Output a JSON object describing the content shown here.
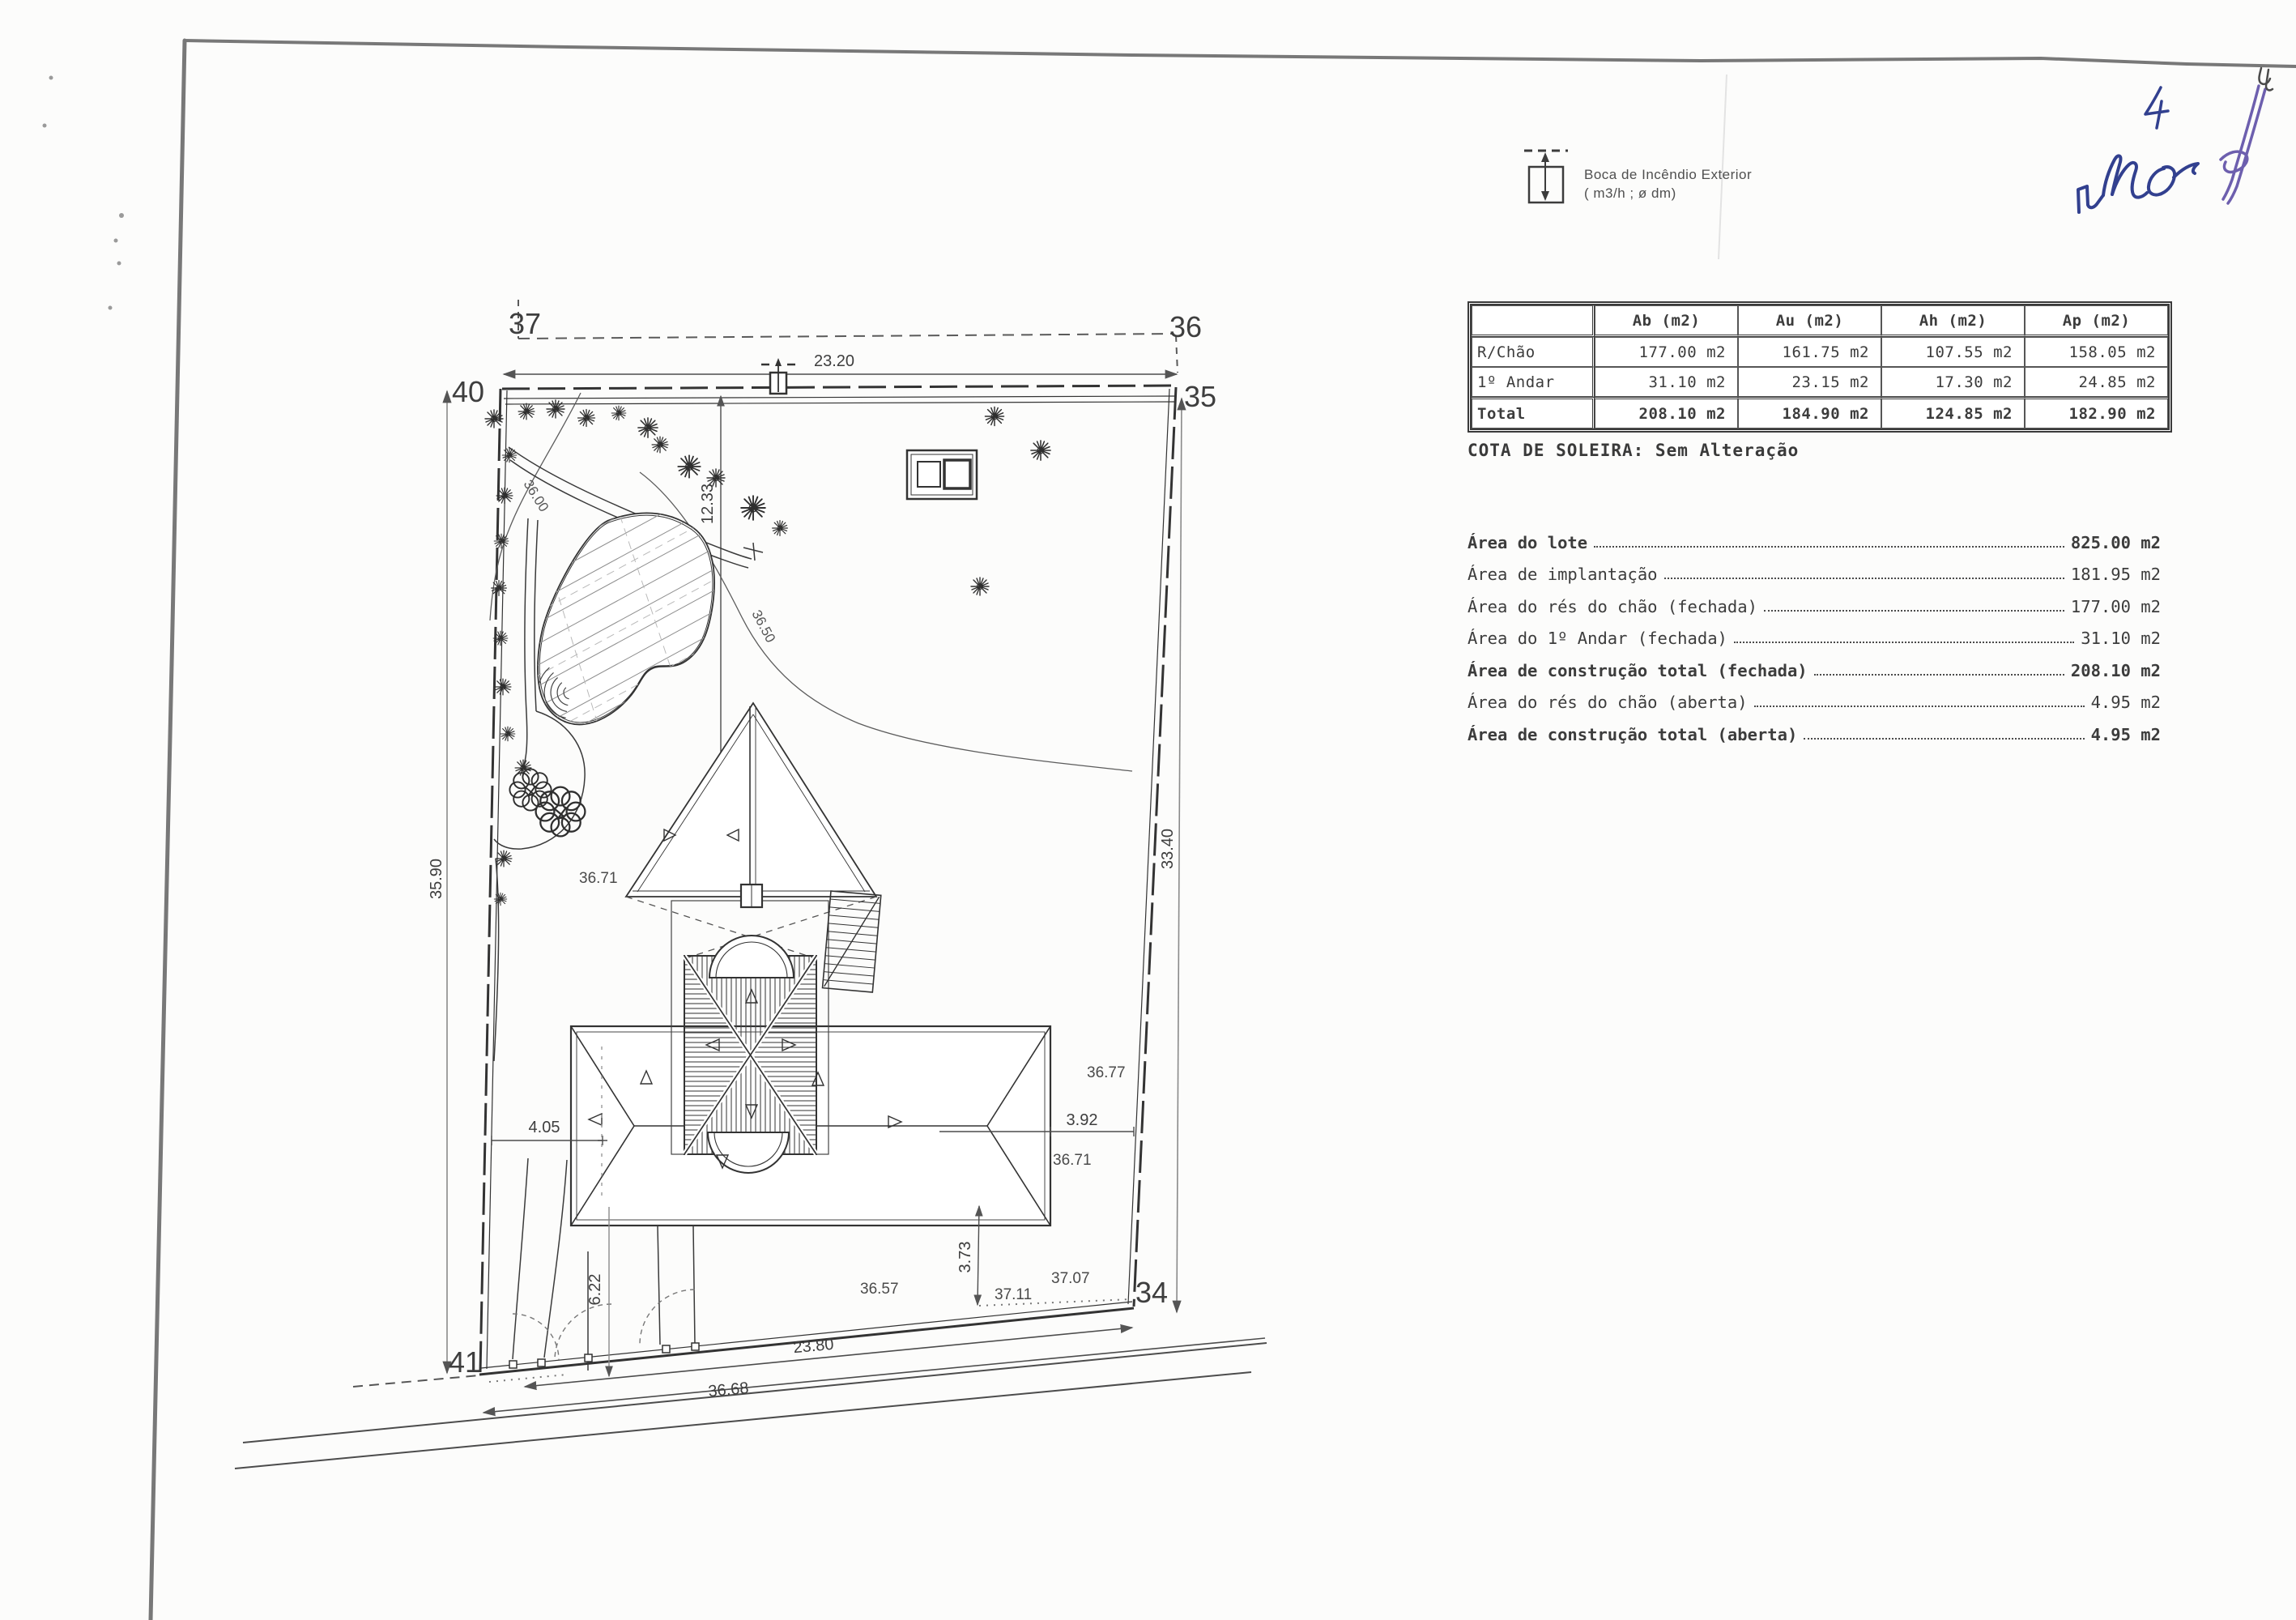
{
  "page": {
    "background": "#fcfcfb",
    "paper_edge_color": "#777777"
  },
  "legend": {
    "icon": "fire-hydrant-icon",
    "line1": "Boca de Incêndio Exterior",
    "line2": "( m3/h ;  ø dm)"
  },
  "areas_table": {
    "col_headers": [
      "",
      "Ab (m2)",
      "Au (m2)",
      "Ah (m2)",
      "Ap (m2)"
    ],
    "rows": [
      {
        "label": "R/Chão",
        "values": [
          "177.00 m2",
          "161.75 m2",
          "107.55 m2",
          "158.05 m2"
        ]
      },
      {
        "label": "1º Andar",
        "values": [
          "31.10 m2",
          "23.15 m2",
          "17.30 m2",
          "24.85 m2"
        ]
      },
      {
        "label": "Total",
        "values": [
          "208.10 m2",
          "184.90 m2",
          "124.85 m2",
          "182.90 m2"
        ]
      }
    ]
  },
  "cota_soleira": "COTA DE SOLEIRA: Sem Alteração",
  "area_list": [
    {
      "label": "Área do lote",
      "value": "825.00 m2",
      "bold": true
    },
    {
      "label": "Área de implantação",
      "value": "181.95 m2",
      "bold": false
    },
    {
      "label": "Área do rés do chão (fechada)",
      "value": "177.00 m2",
      "bold": false
    },
    {
      "label": "Área do 1º Andar (fechada)",
      "value": "31.10 m2",
      "bold": false
    },
    {
      "label": "Área de construção total (fechada)",
      "value": "208.10 m2",
      "bold": true
    },
    {
      "label": "Área do rés do chão (aberta)",
      "value": "4.95 m2",
      "bold": false
    },
    {
      "label": "Área de construção total (aberta)",
      "value": "4.95 m2",
      "bold": true
    }
  ],
  "plan": {
    "corners": {
      "c37": "37",
      "c36": "36",
      "c40": "40",
      "c35": "35",
      "c34": "34",
      "c41": "41"
    },
    "dims": {
      "top": "23.20",
      "left": "35.90",
      "right": "33.40",
      "bottom": "23.80",
      "road": "36.68",
      "setback": "12.33",
      "house_left": "4.05",
      "house_right": "3.92",
      "gate": "6.22",
      "house_bottom": "3.73"
    },
    "levels": {
      "contour_a": "36.00",
      "contour_b": "36.50",
      "spot_1": "36.71",
      "spot_2": "36.77",
      "spot_3": "36.71",
      "spot_4": "36.57",
      "spot_5": "37.11",
      "spot_6": "37.07"
    }
  },
  "handwriting": {
    "page_number": "4",
    "note": "ruc",
    "ink_blue": "#32408f",
    "ink_purple": "#6d5fae"
  }
}
